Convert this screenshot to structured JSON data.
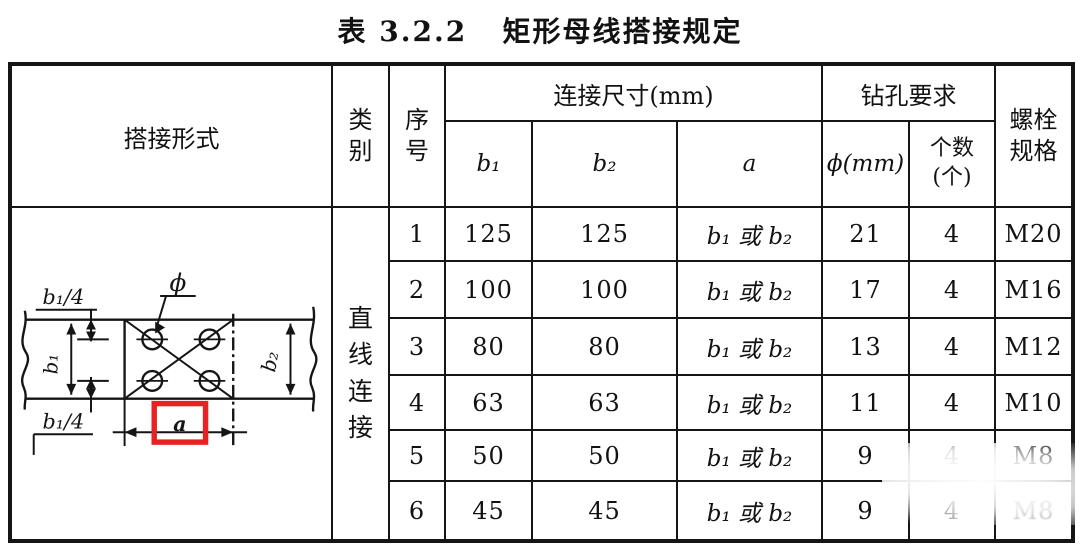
{
  "title": "表 3.2.2   矩形母线搭接规定",
  "table": {
    "headers": {
      "lap_form": "搭接形式",
      "category": "类\n别",
      "serial": "序\n号",
      "connection_dims": "连接尺寸(mm)",
      "b1": "b₁",
      "b2": "b₂",
      "a": "a",
      "drill_req": "钻孔要求",
      "phi": "ϕ(mm)",
      "count": "个数\n(个)",
      "bolt_spec": "螺栓\n规格"
    },
    "category_value": "直\n线\n连\n接",
    "rows": [
      {
        "no": "1",
        "b1": "125",
        "b2": "125",
        "a": "b₁ 或 b₂",
        "phi": "21",
        "count": "4",
        "bolt": "M20"
      },
      {
        "no": "2",
        "b1": "100",
        "b2": "100",
        "a": "b₁ 或 b₂",
        "phi": "17",
        "count": "4",
        "bolt": "M16"
      },
      {
        "no": "3",
        "b1": "80",
        "b2": "80",
        "a": "b₁ 或 b₂",
        "phi": "13",
        "count": "4",
        "bolt": "M12"
      },
      {
        "no": "4",
        "b1": "63",
        "b2": "63",
        "a": "b₁ 或 b₂",
        "phi": "11",
        "count": "4",
        "bolt": "M10"
      },
      {
        "no": "5",
        "b1": "50",
        "b2": "50",
        "a": "b₁ 或 b₂",
        "phi": "9",
        "count": "4",
        "bolt": "M8"
      },
      {
        "no": "6",
        "b1": "45",
        "b2": "45",
        "a": "b₁ 或 b₂",
        "phi": "9",
        "count": "4",
        "bolt": "M8"
      }
    ]
  },
  "diagram": {
    "labels": {
      "b1_quarter_top": "b₁/4",
      "b1_quarter_bottom": "b₁/4",
      "b1": "b₁",
      "b2": "b₂",
      "phi": "ϕ",
      "a": "a"
    }
  },
  "colors": {
    "ink": "#151515",
    "background": "#ffffff",
    "highlight_red": "#e62222"
  }
}
